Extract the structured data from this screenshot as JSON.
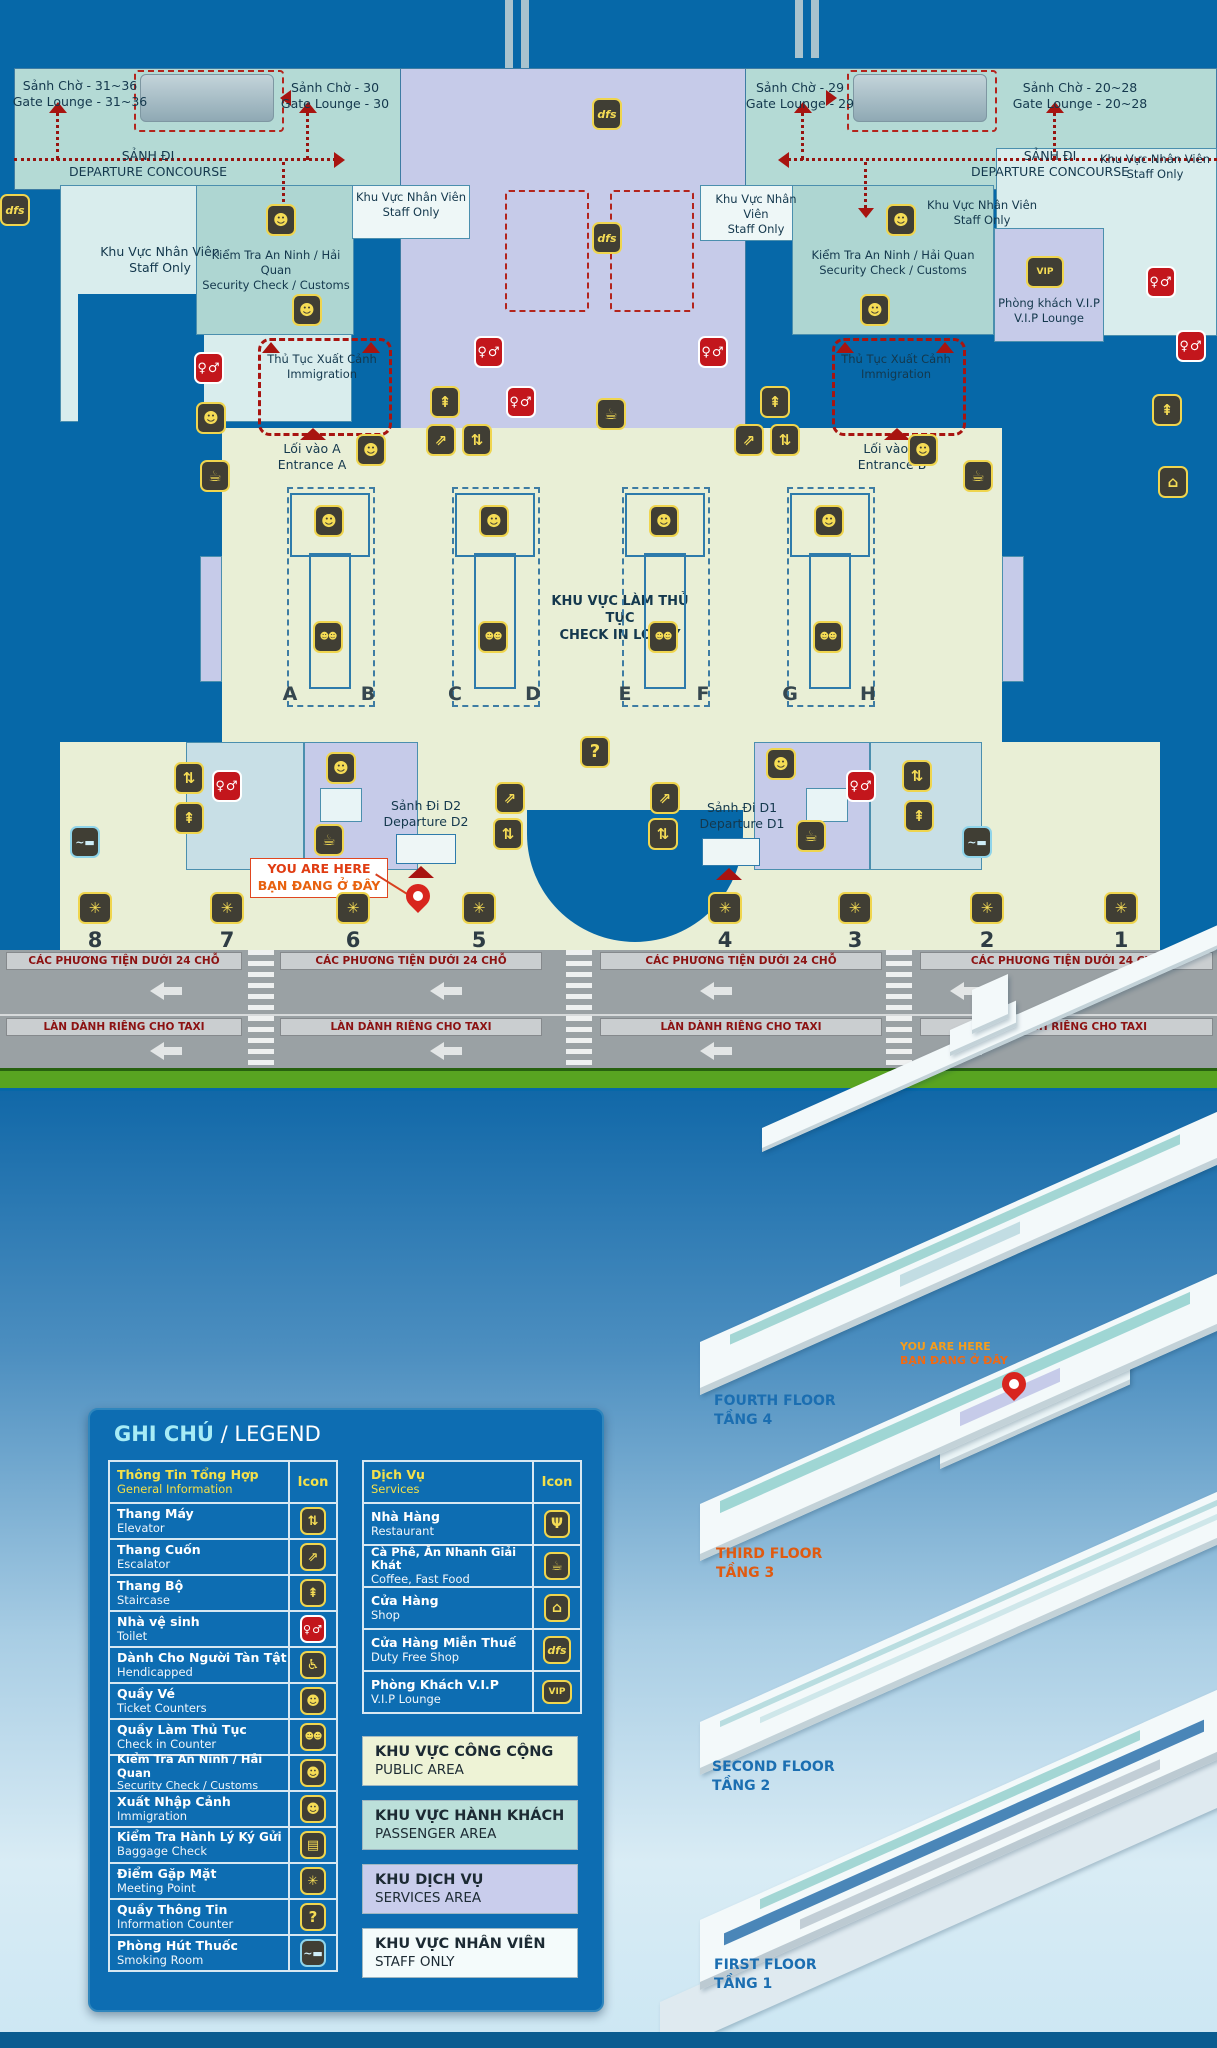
{
  "icons": {
    "elevator": "⇅",
    "escalator": "⇗",
    "staircase": "⇞",
    "toilet": "♀♂",
    "handicapped": "♿",
    "ticket_counter": "☻",
    "checkin_counter": "☻☻",
    "security_check": "☻",
    "immigration_officer": "☻",
    "baggage_check": "▤",
    "meeting_point": "✳",
    "information": "?",
    "smoking": "~▬",
    "restaurant": "Ψ",
    "coffee": "☕",
    "shop": "⌂",
    "dfs": "dfs",
    "vip": "VIP"
  },
  "map": {
    "gate_lounges": [
      {
        "vi": "Sảnh Chờ - 31~36",
        "en": "Gate Lounge - 31~36"
      },
      {
        "vi": "Sảnh Chờ - 30",
        "en": "Gate Lounge - 30"
      },
      {
        "vi": "Sảnh Chờ - 29",
        "en": "Gate Lounge - 29"
      },
      {
        "vi": "Sảnh Chờ - 20~28",
        "en": "Gate Lounge - 20~28"
      }
    ],
    "departure_concourse": {
      "vi": "SẢNH ĐI",
      "en": "DEPARTURE CONCOURSE"
    },
    "staff_only": {
      "vi": "Khu Vực Nhân Viên",
      "en": "Staff Only"
    },
    "security": {
      "vi": "Kiểm Tra An Ninh / Hải Quan",
      "en": "Security Check / Customs"
    },
    "immigration": {
      "vi": "Thủ Tục Xuất Cảnh",
      "en": "Immigration"
    },
    "vip_lounge": {
      "vi": "Phòng khách V.I.P",
      "en": "V.I.P Lounge"
    },
    "entrance_a": {
      "vi": "Lối vào A",
      "en": "Entrance A"
    },
    "entrance_b": {
      "vi": "Lối vào B",
      "en": "Entrance B"
    },
    "checkin_lobby": {
      "vi": "KHU VỰC LÀM THỦ TỤC",
      "en": "CHECK IN LOBBY"
    },
    "islands": [
      {
        "left": "A",
        "right": "B"
      },
      {
        "left": "C",
        "right": "D"
      },
      {
        "left": "E",
        "right": "F"
      },
      {
        "left": "G",
        "right": "H"
      }
    ],
    "departure_d2": {
      "vi": "Sảnh Đi D2",
      "en": "Departure D2"
    },
    "departure_d1": {
      "vi": "Sảnh Đi D1",
      "en": "Departure D1"
    },
    "you_are_here": {
      "en": "YOU ARE HERE",
      "vi": "BẠN ĐANG Ở ĐÂY"
    },
    "meeting_points": [
      "8",
      "7",
      "6",
      "5",
      "4",
      "3",
      "2",
      "1"
    ],
    "road_vehicle_label": "CÁC PHƯƠNG TIỆN DƯỚI 24 CHỖ",
    "road_taxi_label": "LÀN DÀNH RIÊNG CHO TAXI"
  },
  "legend": {
    "title_vi": "GHI CHÚ",
    "title_sep": " / ",
    "title_en": "LEGEND",
    "general": {
      "header": {
        "vi": "Thông Tin Tổng Hợp",
        "en": "General Information",
        "icon_label": "Icon"
      },
      "rows": [
        {
          "vi": "Thang Máy",
          "en": "Elevator",
          "icon": "elevator"
        },
        {
          "vi": "Thang Cuốn",
          "en": "Escalator",
          "icon": "escalator"
        },
        {
          "vi": "Thang Bộ",
          "en": "Staircase",
          "icon": "staircase"
        },
        {
          "vi": "Nhà vệ sinh",
          "en": "Toilet",
          "icon": "toilet"
        },
        {
          "vi": "Dành Cho Người Tàn Tật",
          "en": "Hendicapped",
          "icon": "handicapped"
        },
        {
          "vi": "Quầy Vé",
          "en": "Ticket Counters",
          "icon": "ticket_counter"
        },
        {
          "vi": "Quầy Làm Thủ Tục",
          "en": "Check in Counter",
          "icon": "checkin_counter"
        },
        {
          "vi": "Kiểm Tra An Ninh / Hải Quan",
          "en": "Security Check / Customs",
          "icon": "security_check"
        },
        {
          "vi": "Xuất Nhập Cảnh",
          "en": "Immigration",
          "icon": "immigration_officer"
        },
        {
          "vi": "Kiểm Tra Hành Lý Ký Gửi",
          "en": "Baggage Check",
          "icon": "baggage_check"
        },
        {
          "vi": "Điểm Gặp Mặt",
          "en": "Meeting Point",
          "icon": "meeting_point"
        },
        {
          "vi": "Quầy Thông Tin",
          "en": "Information Counter",
          "icon": "information"
        },
        {
          "vi": "Phòng Hút Thuốc",
          "en": "Smoking Room",
          "icon": "smoking"
        }
      ]
    },
    "services": {
      "header": {
        "vi": "Dịch Vụ",
        "en": "Services",
        "icon_label": "Icon"
      },
      "rows": [
        {
          "vi": "Nhà Hàng",
          "en": "Restaurant",
          "icon": "restaurant"
        },
        {
          "vi": "Cà Phê, Ăn Nhanh Giải Khát",
          "en": "Coffee, Fast Food",
          "icon": "coffee"
        },
        {
          "vi": "Cửa Hàng",
          "en": "Shop",
          "icon": "shop"
        },
        {
          "vi": "Cửa Hàng Miễn Thuế",
          "en": "Duty Free Shop",
          "icon": "dfs"
        },
        {
          "vi": "Phòng Khách V.I.P",
          "en": "V.I.P Lounge",
          "icon": "vip"
        }
      ]
    },
    "areas": [
      {
        "vi": "KHU VỰC CÔNG CỘNG",
        "en": "PUBLIC AREA",
        "color": "#eef3d6"
      },
      {
        "vi": "KHU VỰC HÀNH KHÁCH",
        "en": "PASSENGER AREA",
        "color": "#bce0da"
      },
      {
        "vi": "KHU DỊCH VỤ",
        "en": "SERVICES  AREA",
        "color": "#c9cdec"
      },
      {
        "vi": "KHU VỰC NHÂN VIÊN",
        "en": "STAFF ONLY",
        "color": "#f4fbfb"
      }
    ]
  },
  "iso": {
    "floors": [
      {
        "en": "FOURTH FLOOR",
        "vi": "TẦNG 4"
      },
      {
        "en": "THIRD FLOOR",
        "vi": "TẦNG 3"
      },
      {
        "en": "SECOND FLOOR",
        "vi": "TẦNG 2"
      },
      {
        "en": "FIRST FLOOR",
        "vi": "TẦNG 1"
      }
    ],
    "you_are_here": {
      "en": "YOU ARE HERE",
      "vi": "BẠN ĐANG Ở ĐÂY"
    }
  },
  "colors": {
    "map_background": "#0668a8",
    "concourse_teal": "#b4dad5",
    "staff_area": "#d9eded",
    "services_lavender": "#c6cbe9",
    "public_lobby": "#e9efd6",
    "legend_panel_blue": "#0d6db2",
    "accent_yellow": "#f3e04a",
    "icon_dark": "#403e34",
    "icon_yellow": "#efd54e",
    "alert_red": "#c3161c",
    "path_red": "#971410",
    "road_gray": "#9aa1a4",
    "green_strip": "#58a421",
    "floor_label_blue": "#1b6eb1",
    "third_floor_orange": "#e05a10"
  }
}
